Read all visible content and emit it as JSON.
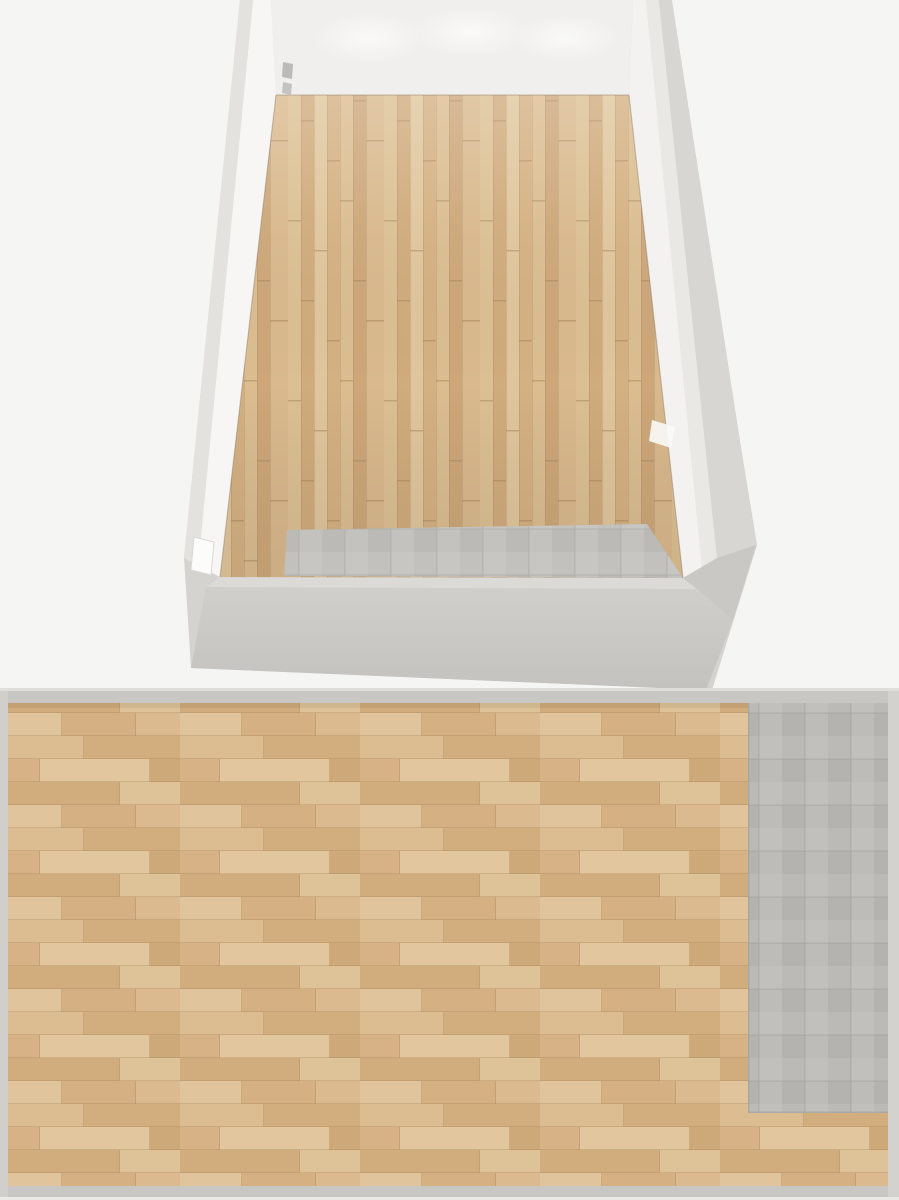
{
  "meta": {
    "description": "Gym floor plan render with a 3D perspective view (top) and a 2D top-down plan view (bottom)",
    "views": [
      "perspective-3d",
      "floor-plan-2d"
    ]
  },
  "palette": {
    "background": "#f5f5f4",
    "wall_far": "#f0efed",
    "wall_left_inner": "#f7f6f4",
    "wall_right_inner": "#f3f2f0",
    "wall_band_left": "#e3e2de",
    "wall_band_right": "#e9e8e4",
    "wall_outer": "#d4d3cf",
    "wall_front_band": "#dbdad6",
    "wall_2d": "#c8c7c3",
    "door_white": "#fcfcfb",
    "equip_shell": "#232326",
    "equip_black": "#131316",
    "belt": "#19191b",
    "yellow": "#ab8a32",
    "red": "#a32020",
    "red_dark": "#6e1315",
    "red_dot": "#c23b2e",
    "silver": "#c2c2c5",
    "gray_frame": "#9a9a9e",
    "cream": "#eae7dc",
    "green": "#46a33c",
    "screen": "#24202a",
    "white_box": "#e8e8e6",
    "flywheel": "#a79da6",
    "blue": "#3f6fd0"
  },
  "perspective_view": {
    "items": [
      {
        "type": "rack3d",
        "name": "power-rack",
        "x": 363,
        "y": 92,
        "rot": 0,
        "scale": 1
      },
      {
        "type": "benchrack3d",
        "name": "barbell-rack",
        "x": 452,
        "y": 114,
        "rot": -2,
        "scale": 1
      },
      {
        "type": "bench3d",
        "name": "adjustable-bench",
        "x": 488,
        "y": 124,
        "rot": 0,
        "scale": 1
      },
      {
        "type": "tm3d",
        "name": "treadmill-1",
        "x": 548,
        "y": 118,
        "rot": 22,
        "scale": 0.97
      },
      {
        "type": "tm3d",
        "name": "treadmill-2",
        "x": 546,
        "y": 159,
        "rot": 19,
        "scale": 1
      },
      {
        "type": "tm3d",
        "name": "treadmill-3",
        "x": 545,
        "y": 199,
        "rot": 17,
        "scale": 1.02
      },
      {
        "type": "rower3d",
        "name": "rowing-machine-1",
        "x": 562,
        "y": 252,
        "rot": 16,
        "scale": 1
      },
      {
        "type": "rower3d",
        "name": "rowing-machine-2",
        "x": 569,
        "y": 287,
        "rot": 15,
        "scale": 1.02
      },
      {
        "type": "bike3d",
        "name": "exercise-bike-1",
        "x": 585,
        "y": 331,
        "rot": 16,
        "scale": 1
      },
      {
        "type": "bike3d",
        "name": "exercise-bike-2",
        "x": 589,
        "y": 373,
        "rot": 15,
        "scale": 1.04
      },
      {
        "type": "ell3d",
        "name": "elliptical-1",
        "x": 596,
        "y": 440,
        "rot": 16,
        "scale": 1.06
      },
      {
        "type": "ell3d",
        "name": "elliptical-2",
        "x": 600,
        "y": 485,
        "rot": 15,
        "scale": 1.08
      },
      {
        "type": "latpull3d",
        "name": "lat-pulldown-machine",
        "x": 299,
        "y": 193,
        "rot": 12,
        "scale": 0.97
      },
      {
        "type": "redseat3d",
        "name": "weight-machine-red-seat",
        "x": 299,
        "y": 261,
        "rot": 12,
        "scale": 1
      },
      {
        "type": "benchmach3d",
        "name": "weight-machine-bench",
        "x": 291,
        "y": 338,
        "rot": 12,
        "scale": 1.05
      },
      {
        "type": "pecdeck3d",
        "name": "pec-deck-machine",
        "x": 278,
        "y": 424,
        "rot": 12,
        "scale": 1.1
      },
      {
        "type": "mat3d",
        "name": "exercise-mat-stack",
        "x": 357,
        "y": 264,
        "rot": 0,
        "scale": 1
      }
    ]
  },
  "plan_view": {
    "items": [
      {
        "type": "treadmill",
        "name": "treadmill-1",
        "x": 78,
        "y": 787,
        "rot": 0
      },
      {
        "type": "treadmill",
        "name": "treadmill-2",
        "x": 164,
        "y": 787,
        "rot": 0
      },
      {
        "type": "treadmill",
        "name": "treadmill-3",
        "x": 249,
        "y": 787,
        "rot": 0
      },
      {
        "type": "rower",
        "name": "rowing-machine-1",
        "x": 351,
        "y": 790,
        "rot": 0
      },
      {
        "type": "rower",
        "name": "rowing-machine-2",
        "x": 412,
        "y": 790,
        "rot": 0
      },
      {
        "type": "bike",
        "name": "exercise-bike-1",
        "x": 504,
        "y": 779,
        "rot": 0
      },
      {
        "type": "bike",
        "name": "exercise-bike-2",
        "x": 571,
        "y": 779,
        "rot": 0
      },
      {
        "type": "elliptical",
        "name": "elliptical-1",
        "x": 645,
        "y": 780,
        "rot": 0
      },
      {
        "type": "elliptical",
        "name": "elliptical-2",
        "x": 703,
        "y": 780,
        "rot": 0
      },
      {
        "type": "flatbench",
        "name": "flat-bench",
        "x": 54,
        "y": 890,
        "rot": 0
      },
      {
        "type": "barbellrack",
        "name": "barbell-rack",
        "x": 41,
        "y": 966,
        "rot": 0
      },
      {
        "type": "powercage",
        "name": "power-rack-with-bench",
        "x": 58,
        "y": 1089,
        "rot": 0
      },
      {
        "type": "preacher",
        "name": "preacher-curl-bench",
        "x": 281,
        "y": 1127,
        "rot": 0
      },
      {
        "type": "legmachine",
        "name": "seated-machine-red",
        "x": 381,
        "y": 1133,
        "rot": 0
      },
      {
        "type": "mat",
        "name": "exercise-mat",
        "x": 443,
        "y": 1061,
        "rot": 0
      },
      {
        "type": "press",
        "name": "plate-loaded-press",
        "x": 526,
        "y": 1134,
        "rot": 0
      },
      {
        "type": "pecdeck",
        "name": "pec-deck-machine",
        "x": 656,
        "y": 1146,
        "rot": 0
      }
    ]
  }
}
